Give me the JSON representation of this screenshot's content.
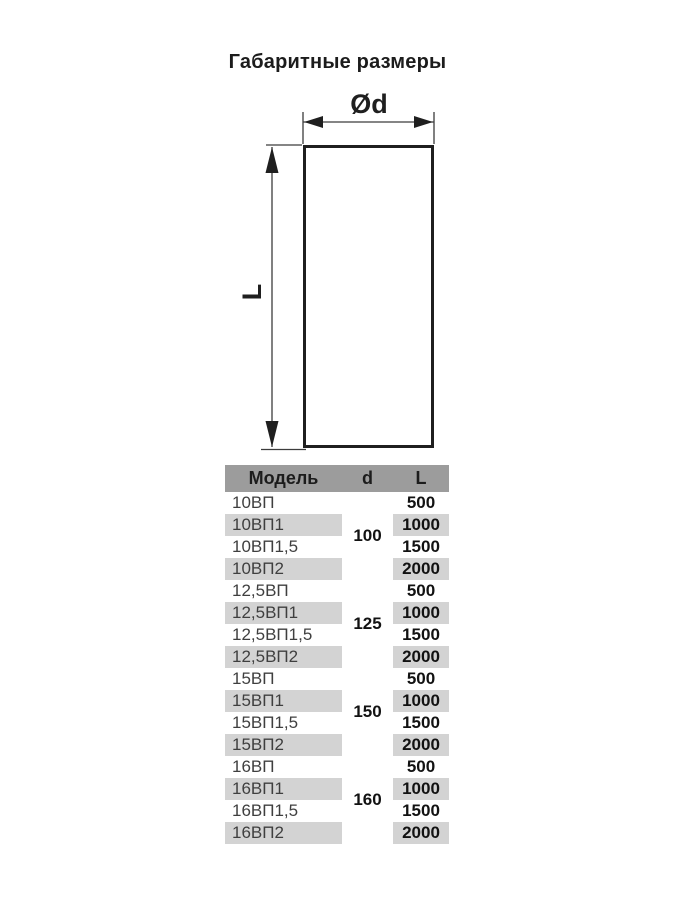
{
  "title": "Габаритные размеры",
  "diagram": {
    "diameter_label": "Ød",
    "length_label": "L"
  },
  "table": {
    "headers": [
      "Модель",
      "d",
      "L"
    ],
    "groups": [
      {
        "d": "100",
        "rows": [
          {
            "model": "10ВП",
            "L": "500"
          },
          {
            "model": "10ВП1",
            "L": "1000"
          },
          {
            "model": "10ВП1,5",
            "L": "1500"
          },
          {
            "model": "10ВП2",
            "L": "2000"
          }
        ]
      },
      {
        "d": "125",
        "rows": [
          {
            "model": "12,5ВП",
            "L": "500"
          },
          {
            "model": "12,5ВП1",
            "L": "1000"
          },
          {
            "model": "12,5ВП1,5",
            "L": "1500"
          },
          {
            "model": "12,5ВП2",
            "L": "2000"
          }
        ]
      },
      {
        "d": "150",
        "rows": [
          {
            "model": "15ВП",
            "L": "500"
          },
          {
            "model": "15ВП1",
            "L": "1000"
          },
          {
            "model": "15ВП1,5",
            "L": "1500"
          },
          {
            "model": "15ВП2",
            "L": "2000"
          }
        ]
      },
      {
        "d": "160",
        "rows": [
          {
            "model": "16ВП",
            "L": "500"
          },
          {
            "model": "16ВП1",
            "L": "1000"
          },
          {
            "model": "16ВП1,5",
            "L": "1500"
          },
          {
            "model": "16ВП2",
            "L": "2000"
          }
        ]
      }
    ]
  },
  "colors": {
    "header_bg": "#9c9c9c",
    "row_shade": "#d3d3d3",
    "line": "#3c3c3c",
    "ink": "#1c1c1c"
  }
}
